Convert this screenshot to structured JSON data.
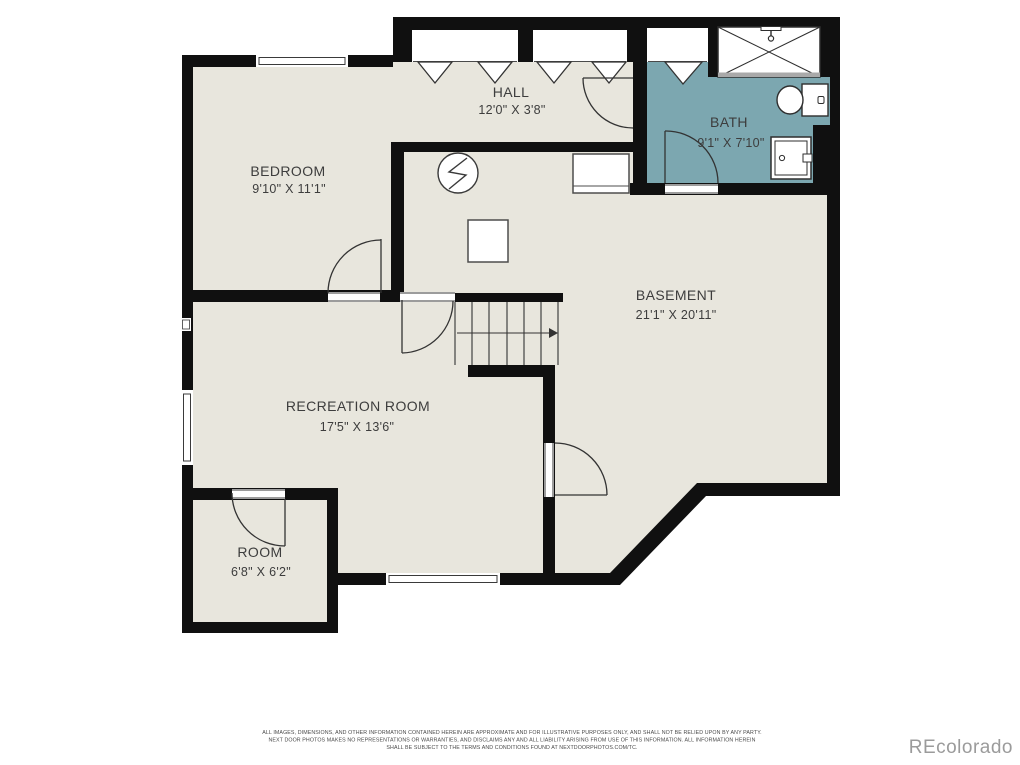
{
  "rooms": {
    "bedroom": {
      "name": "BEDROOM",
      "dims": "9'10\" X 11'1\""
    },
    "hall": {
      "name": "HALL",
      "dims": "12'0\" X 3'8\""
    },
    "bath": {
      "name": "BATH",
      "dims": "9'1\" X 7'10\""
    },
    "basement": {
      "name": "BASEMENT",
      "dims": "21'1\" X 20'11\""
    },
    "recreation": {
      "name": "RECREATION ROOM",
      "dims": "17'5\" X 13'6\""
    },
    "room": {
      "name": "ROOM",
      "dims": "6'8\" X 6'2\""
    }
  },
  "footer": {
    "disclaimer_line1": "ALL IMAGES, DIMENSIONS, AND OTHER INFORMATION CONTAINED HEREIN ARE APPROXIMATE AND FOR ILLUSTRATIVE PURPOSES ONLY, AND SHALL NOT BE RELIED UPON BY ANY PARTY.",
    "disclaimer_line2": "NEXT DOOR PHOTOS MAKES NO REPRESENTATIONS OR WARRANTIES, AND DISCLAIMS ANY AND ALL LIABILITY ARISING FROM USE OF THIS INFORMATION. ALL INFORMATION HEREIN",
    "disclaimer_line3": "SHALL BE SUBJECT TO THE TERMS AND CONDITIONS FOUND AT NEXTDOORPHOTOS.COM/TC.",
    "watermark": "REcolorado"
  },
  "colors": {
    "floor": "#e8e6dd",
    "bath": "#7ca7b0",
    "wall": "#101010"
  }
}
